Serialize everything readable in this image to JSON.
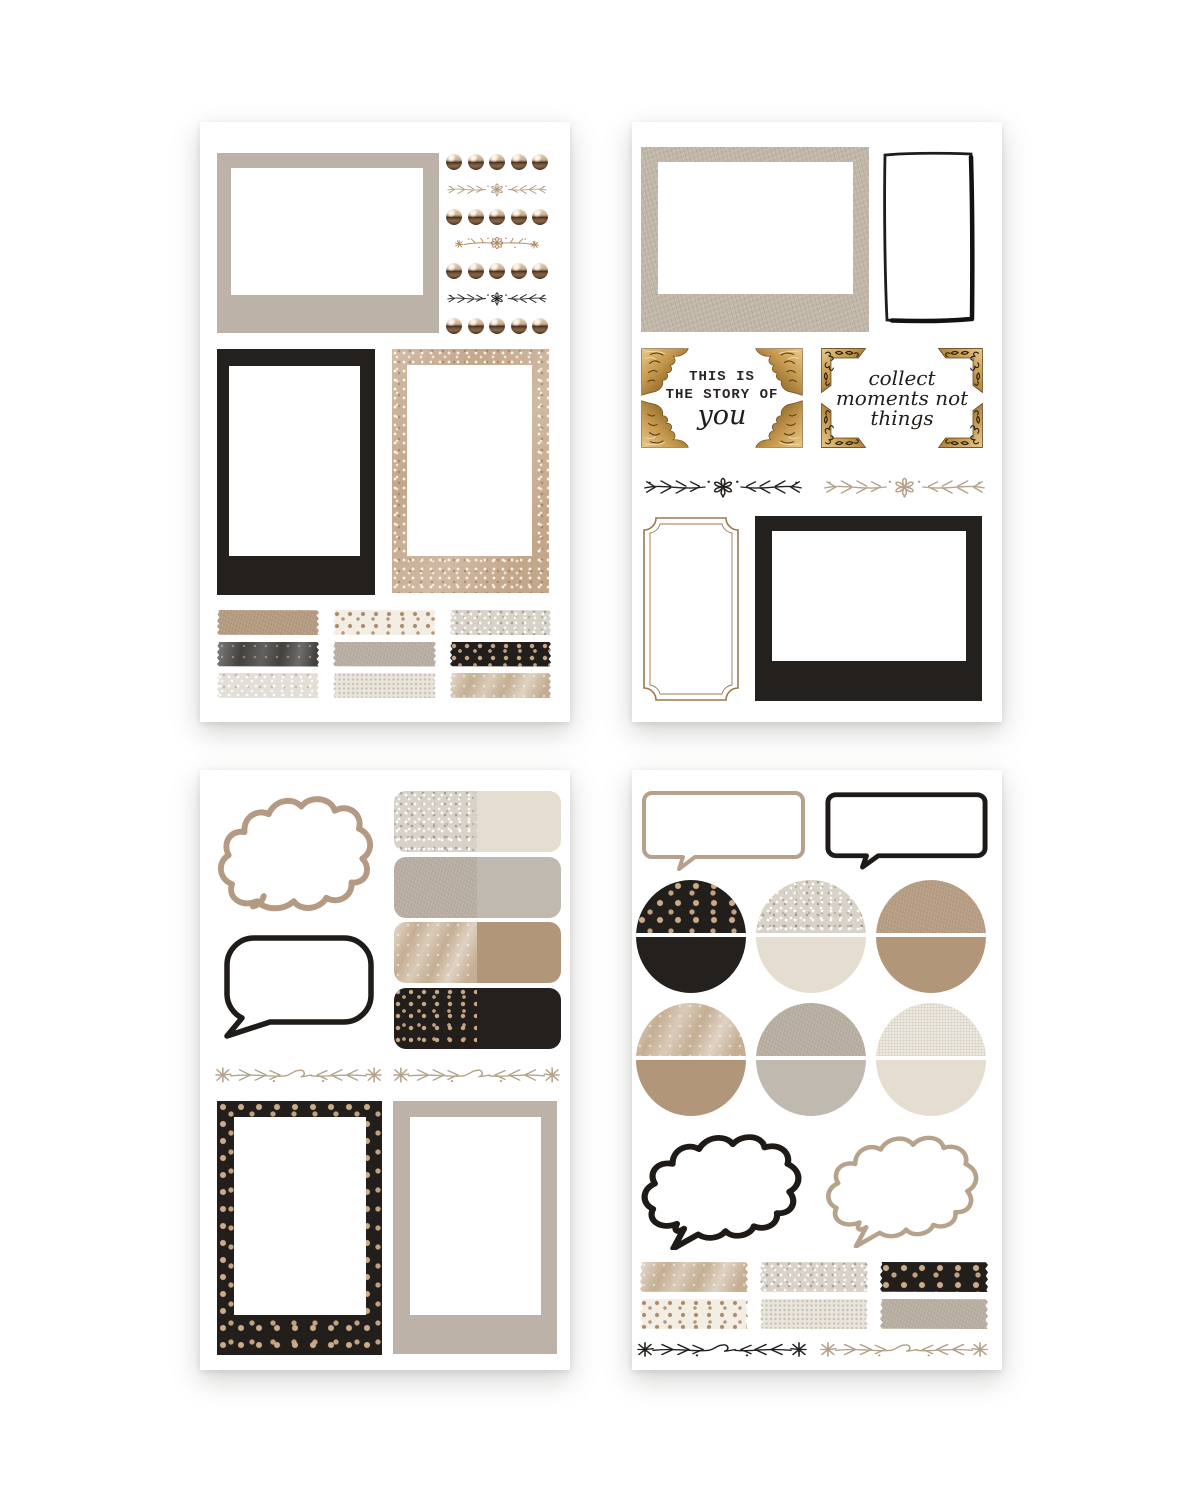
{
  "page": {
    "title": "Neutral journaling sticker sheets",
    "background": "#ffffff",
    "sheet_count": 4
  },
  "palette": {
    "greige": "#bdb2a8",
    "black": "#24201e",
    "cream": "#e5ddd0",
    "camel": "#b2967a",
    "gray_greige": "#c0b9af",
    "gold": "#c89b50",
    "tan_line": "#b5a28a",
    "ink": "#26221f",
    "ticket_brown": "#9b7952"
  },
  "sheets": {
    "s1": {
      "name": "frames, brads and washi tape",
      "frame_top": {
        "tex": "greige"
      },
      "brads": {
        "rows": 4,
        "per_row": 5,
        "color": "copper"
      },
      "flourishes": [
        "vine-daisy-tan",
        "floral-spray-tan",
        "vine-daisy-black"
      ],
      "polaroid": {
        "tex": "black"
      },
      "frame_glitter": {
        "tex": "glitter-champagne"
      },
      "washi": [
        "camel-leather",
        "dots-tan-cream",
        "glitter-silver",
        "marble-dark",
        "greige-leather",
        "dots-gold-black",
        "glitter-light",
        "lace-white",
        "marble-tan"
      ]
    },
    "s2": {
      "name": "quote corners and frames",
      "frame_leather": {
        "tex": "leather-frame"
      },
      "frame_drawn": {
        "stroke": "#1f1c1a"
      },
      "quote_story": {
        "line1": "THIS IS",
        "line2": "THE STORY OF",
        "line3": "you"
      },
      "quote_collect": {
        "line1": "collect",
        "line2": "moments not",
        "line3": "things"
      },
      "flourishes": [
        "vine-daisy-black",
        "vine-daisy-tan"
      ],
      "ticket": {
        "stroke": "#9b7952"
      },
      "frame_black": {
        "tex": "black"
      }
    },
    "s3": {
      "name": "speech bubbles, labels and polaroids",
      "cloud": {
        "stroke": "#b49a82"
      },
      "labels": [
        {
          "left": "glitter-silver",
          "right": "cream"
        },
        {
          "left": "greige-leather",
          "right": "gray-greige"
        },
        {
          "left": "marble-tan",
          "right": "camel"
        },
        {
          "left": "dots-gold-black",
          "right": "black"
        }
      ],
      "bubble": {
        "stroke": "#1f1b19"
      },
      "flourishes": [
        "vine-loop-tan",
        "vine-loop-tan"
      ],
      "polaroid_dotted": {
        "tex": "dots-gold-black"
      },
      "polaroid_plain": {
        "tex": "greige"
      }
    },
    "s4": {
      "name": "bubbles, half circles and washi tape",
      "bubble_tan": {
        "stroke": "#b6a28c"
      },
      "bubble_black": {
        "stroke": "#1d1a18"
      },
      "circles": [
        {
          "top": "dots-gold-black",
          "bottom": "black"
        },
        {
          "top": "glitter-silver",
          "bottom": "cream"
        },
        {
          "top": "tan-leather",
          "bottom": "camel"
        },
        {
          "top": "marble-tan",
          "bottom": "camel"
        },
        {
          "top": "greige-leather",
          "bottom": "gray-greige"
        },
        {
          "top": "canvas-white",
          "bottom": "cream"
        }
      ],
      "cloud_black": {
        "stroke": "#1d1a18"
      },
      "cloud_tan": {
        "stroke": "#b7a28c"
      },
      "washi": [
        "marble-tan",
        "glitter-silver",
        "dots-gold-black",
        "dots-tan-cream",
        "lace-white",
        "greige-leather"
      ],
      "flourishes": [
        "vine-loop-black",
        "vine-loop-tan"
      ]
    }
  }
}
